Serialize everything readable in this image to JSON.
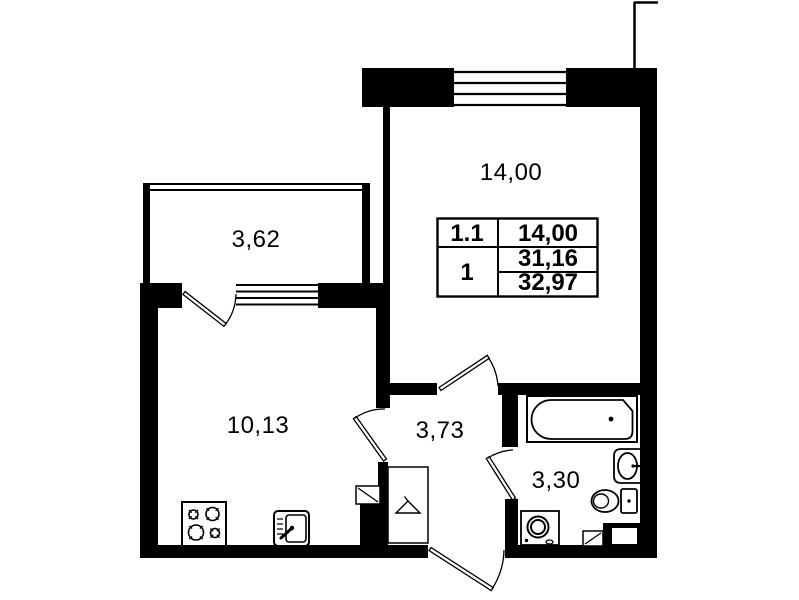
{
  "title": "apartment-floor-plan",
  "rooms": {
    "living": {
      "area": "14,00"
    },
    "balcony": {
      "area": "3,62"
    },
    "kitchen": {
      "area": "10,13"
    },
    "hall": {
      "area": "3,73"
    },
    "bathroom": {
      "area": "3,30"
    }
  },
  "area_table": {
    "unit_row": {
      "number": "1.1",
      "area": "14,00"
    },
    "apartment_row": {
      "number": "1",
      "living_area": "31,16",
      "total_area": "32,97"
    }
  },
  "fixtures": {
    "bathtub": "bathtub",
    "washbasin": "washbasin",
    "toilet": "toilet",
    "washing_machine": "washing-machine",
    "stove": "stove-4-burners",
    "kitchen_sink": "kitchen-sink",
    "wardrobe": "wardrobe-hanger",
    "vent_shaft_hall": "ventilation-shaft",
    "vent_shaft_bath": "ventilation-shaft"
  },
  "colors": {
    "wall": "#000000",
    "background": "#ffffff",
    "line": "#000000"
  }
}
